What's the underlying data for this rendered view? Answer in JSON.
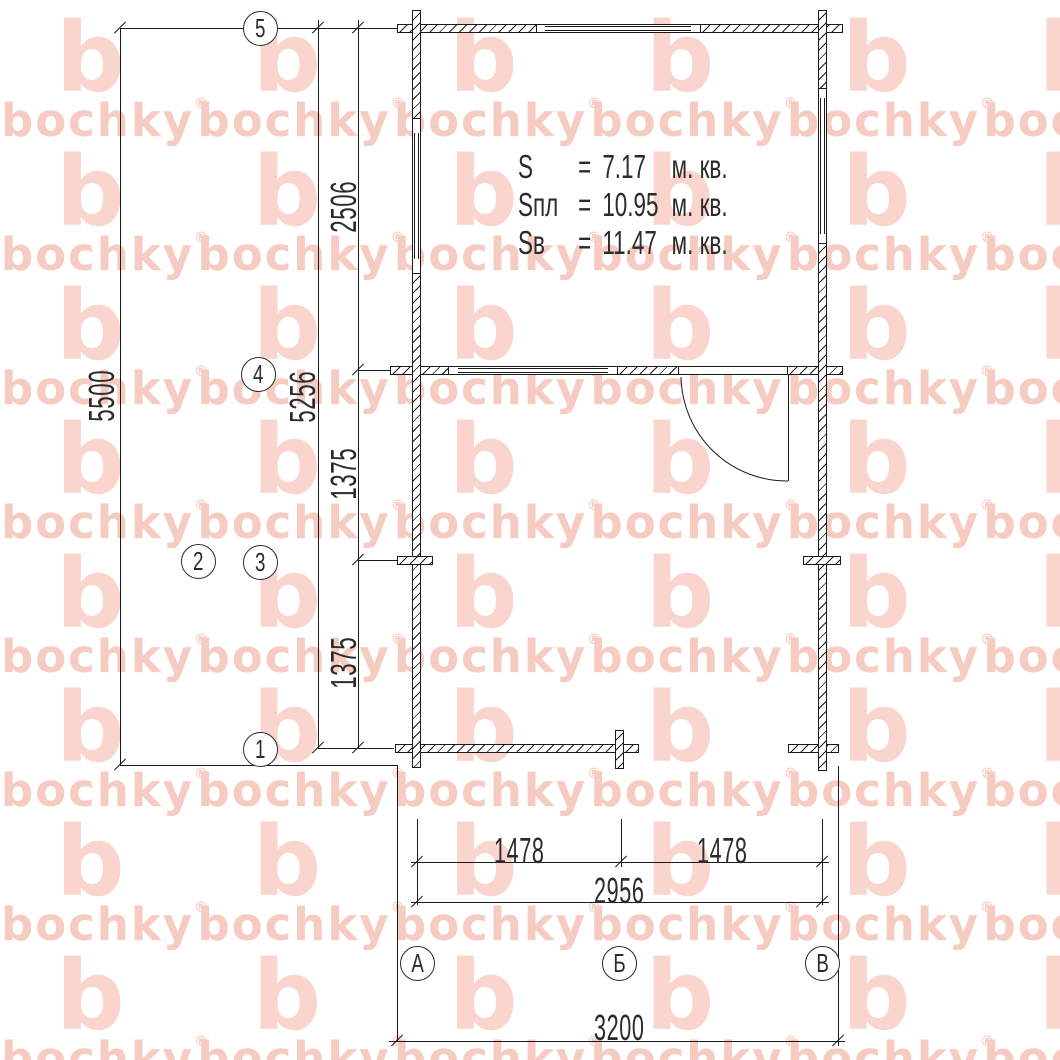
{
  "watermark": {
    "text": "bochky",
    "registered": "®",
    "color_text": "#f6cbc1",
    "color_b": "#f9d5cd"
  },
  "line_color": "#1a1a1a",
  "area_summary": {
    "rows": [
      {
        "label": "S",
        "equals": "=",
        "value": "7.17",
        "unit": "м. кв."
      },
      {
        "label": "Sпл",
        "equals": "=",
        "value": "10.95",
        "unit": "м. кв."
      },
      {
        "label": "Sв",
        "equals": "=",
        "value": "11.47",
        "unit": "м. кв."
      }
    ]
  },
  "axis_bubbles": {
    "horizontal": [
      {
        "label": "5"
      },
      {
        "label": "4"
      },
      {
        "label": "3"
      },
      {
        "label": "2"
      },
      {
        "label": "1"
      }
    ],
    "vertical": [
      {
        "label": "А"
      },
      {
        "label": "Б"
      },
      {
        "label": "В"
      }
    ]
  },
  "dimensions": {
    "v5500": "5500",
    "v5256": "5256",
    "v2506": "2506",
    "v1375a": "1375",
    "v1375b": "1375",
    "h1478a": "1478",
    "h1478b": "1478",
    "h2956": "2956",
    "h3200": "3200"
  }
}
